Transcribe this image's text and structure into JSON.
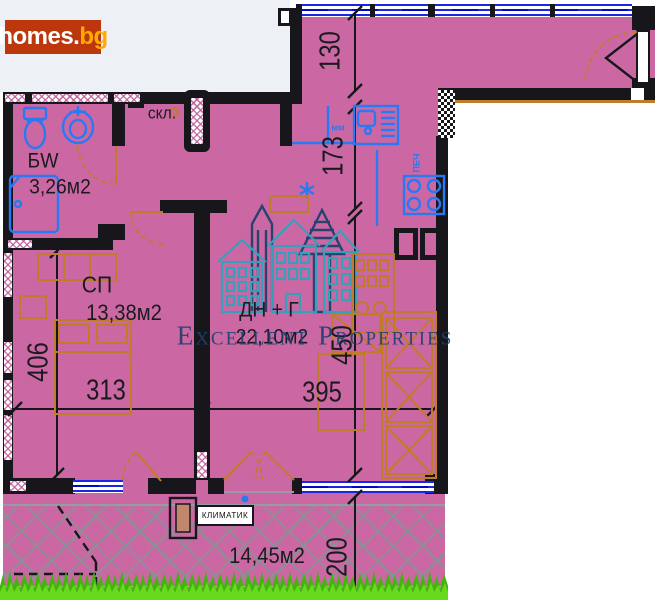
{
  "logo": {
    "part1": "homes.",
    "part2": "bg"
  },
  "watermark": {
    "text": "Excellent Properties"
  },
  "rooms": {
    "bathroom": {
      "label": "БW",
      "area": "3,26м2"
    },
    "storage": {
      "label": "скл."
    },
    "bedroom": {
      "label": "СП",
      "area": "13,38м2"
    },
    "living": {
      "label": "ДН + Г",
      "area": "22,10м2"
    },
    "terrace": {
      "area": "14,45м2"
    }
  },
  "dimensions": {
    "hall_top": "130",
    "kitchen": "173",
    "bedroom_width": "313",
    "bedroom_height": "406",
    "living_width": "395",
    "living_height": "450",
    "terrace_depth": "200"
  },
  "annotations": {
    "air_conditioner": "КЛИМАТИК",
    "mm": "мм",
    "stove": "ПЕЧ"
  },
  "colors": {
    "plan_pink": "#cb68a4",
    "wall_black": "#17171b",
    "window_blue": "#1c24e8",
    "fixture_blue": "#2979f2",
    "furniture_orange": "#c07c28",
    "watermark_teal": "#2fa3bc",
    "watermark_navy": "#20406e",
    "grass_green": "#46b20d",
    "grass_light": "#6ade1f",
    "logo_bg": "#bd370d",
    "logo_accent": "#ffaa00"
  }
}
